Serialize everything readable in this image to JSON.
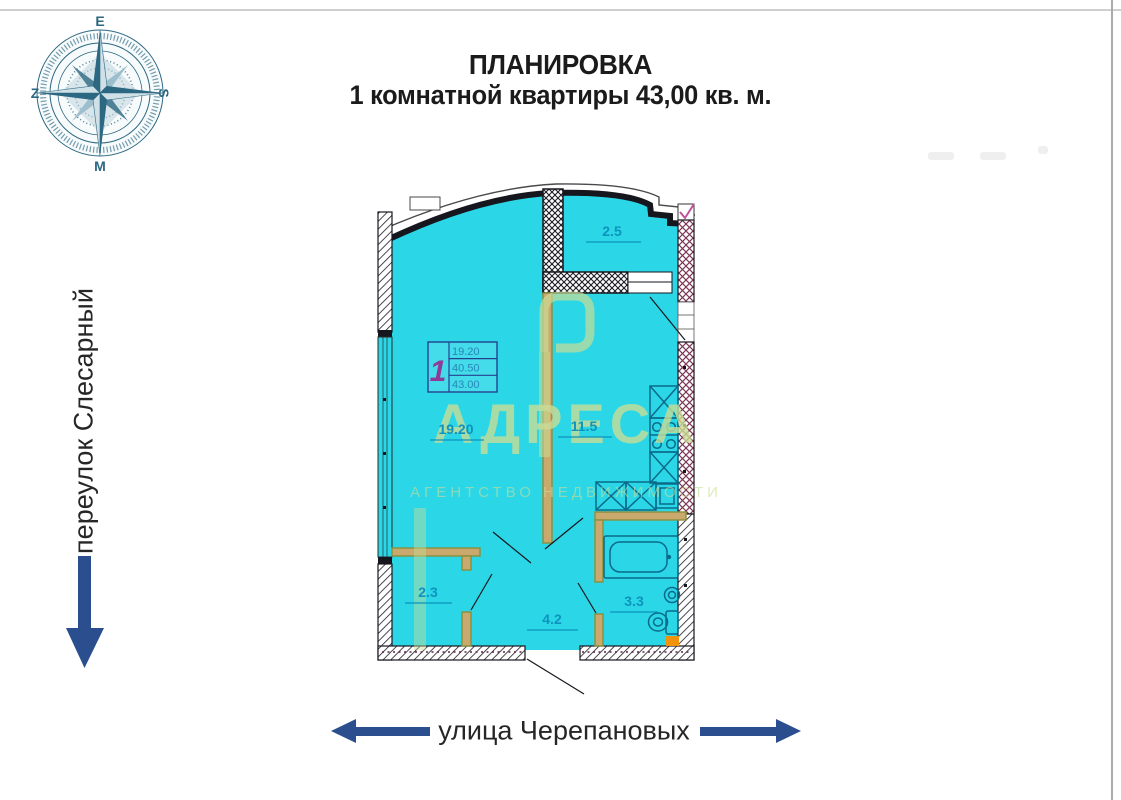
{
  "title": {
    "line1": "ПЛАНИРОВКА",
    "line2": "1 комнатной квартиры 43,00 кв. м."
  },
  "compass": {
    "top": "E",
    "right": "S",
    "bottom": "M",
    "left": "Z"
  },
  "streets": {
    "left_vertical": "переулок Слесарный",
    "bottom_horizontal": "улица Черепановых"
  },
  "plan": {
    "room_areas": {
      "balcony": "2.5",
      "living_room": "19.20",
      "kitchen": "11.5",
      "wardrobe": "2.3",
      "hallway": "4.2",
      "bathroom": "3.3"
    },
    "info_box": {
      "flat_number": "1",
      "rows": [
        "19.20",
        "40.50",
        "43.00"
      ]
    }
  },
  "watermark": {
    "brand": "АДРЕСА",
    "tagline": "АГЕНТСТВО НЕДВИЖИМОСТИ"
  },
  "colors": {
    "floor_fill": "#2bd7e7",
    "label_text": "#0d93bd",
    "wall_dark": "#16161e",
    "partition_outline": "#8a8f3c",
    "partition_fill": "#c9a96e",
    "fixture_stroke": "#0a6a8a",
    "arrow_navy": "#2b4e8e",
    "compass_teal": "#2d6882",
    "flat_number_color": "#8e3a96",
    "watermark_green": "#c9dc96",
    "orange_detail": "#f0920a"
  }
}
